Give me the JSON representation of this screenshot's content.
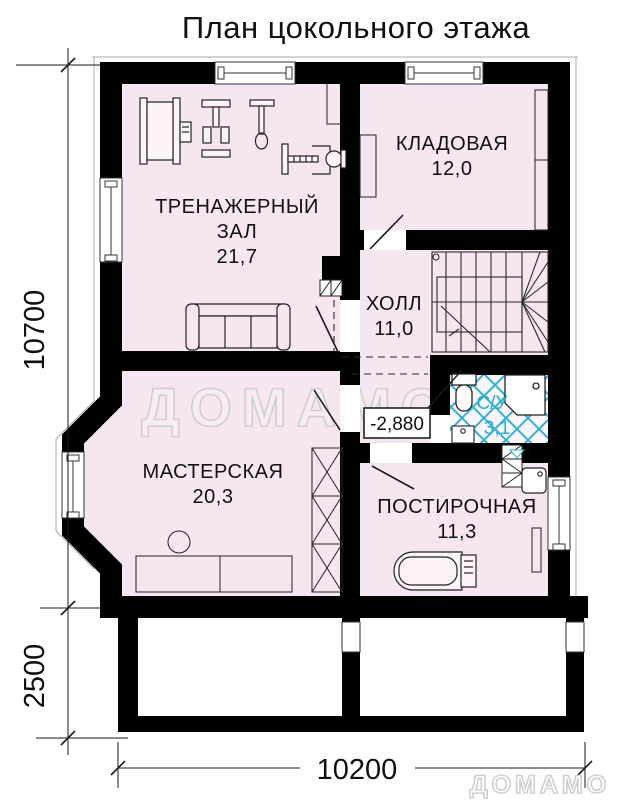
{
  "title": "План цокольного этажа",
  "watermark": {
    "center": "ДОМАМО",
    "corner": "ДОМАМО"
  },
  "rooms": {
    "gym": {
      "line1": "ТРЕНАЖЕРНЫЙ",
      "line2": "ЗАЛ",
      "area": "21,7"
    },
    "storage": {
      "name": "КЛАДОВАЯ",
      "area": "12,0"
    },
    "hall": {
      "name": "ХОЛЛ",
      "area": "11,0"
    },
    "bathroom": {
      "name": "С/У",
      "area": "3,1"
    },
    "workshop": {
      "name": "МАСТЕРСКАЯ",
      "area": "20,3"
    },
    "laundry": {
      "name": "ПОСТИРОЧНАЯ",
      "area": "11,3"
    }
  },
  "elevation_mark": "-2,880",
  "dimensions": {
    "height_total": "10700",
    "height_basement": "2500",
    "width_total": "10200"
  },
  "colors": {
    "wall": "#000000",
    "room_fill": "#f5e6f2",
    "tile_accent": "#2bb3d8",
    "watermark": "#cccccc"
  }
}
